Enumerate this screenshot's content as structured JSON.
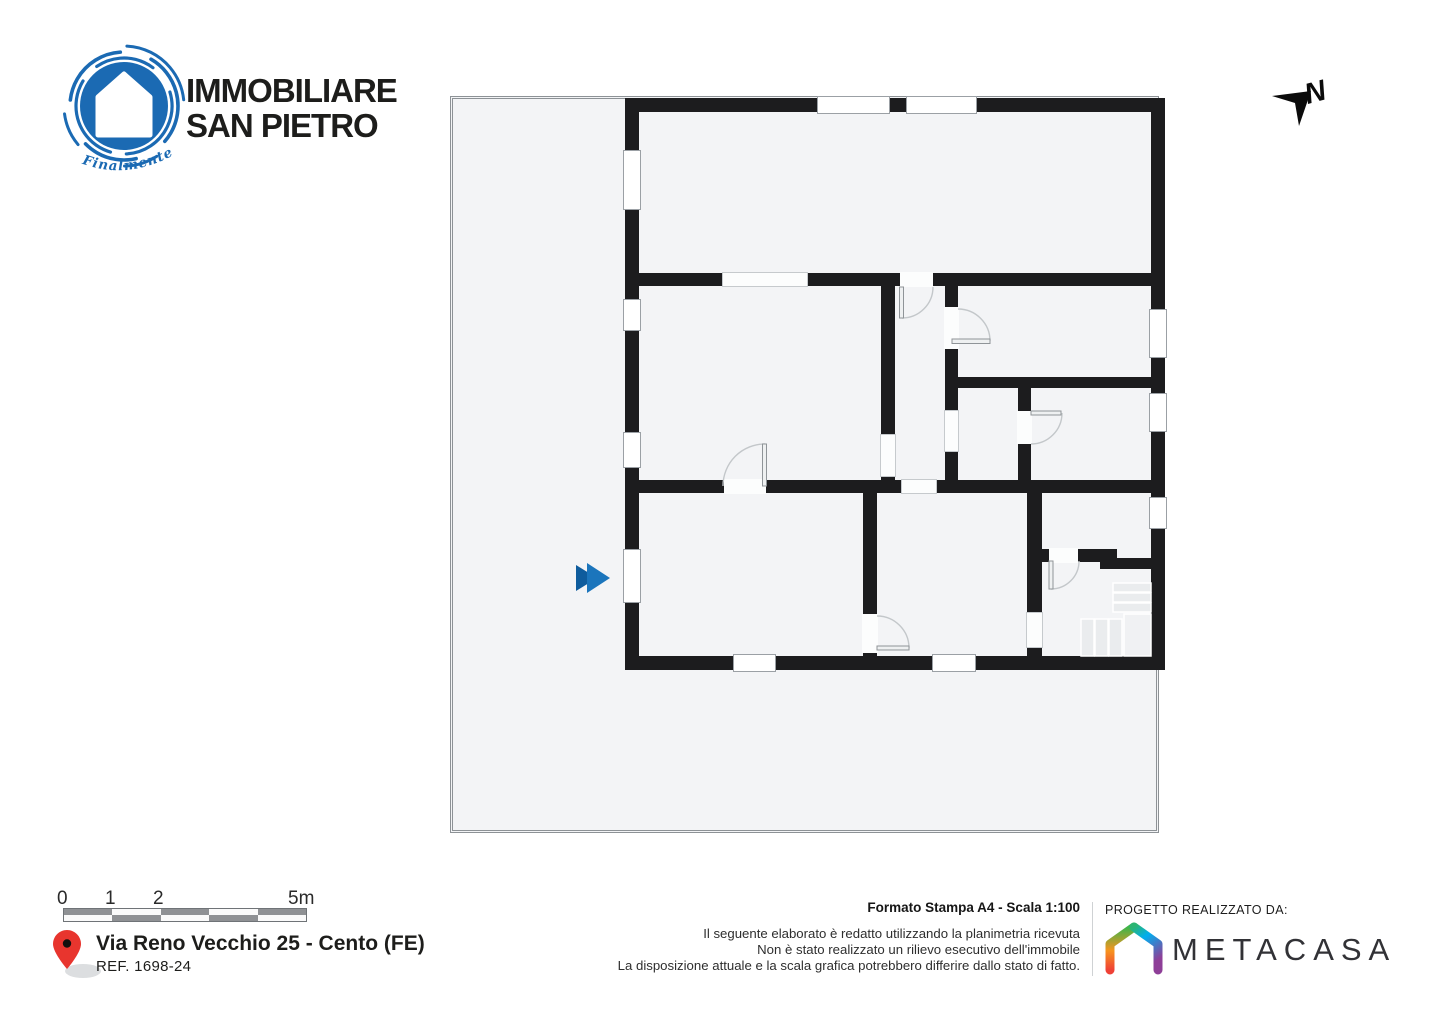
{
  "brand": {
    "name_line1": "IMMOBILIARE",
    "name_line2": "SAN PIETRO",
    "tagline": "Finalmente a Casa",
    "accent_color": "#1b6ab3"
  },
  "compass": {
    "label": "N"
  },
  "floorplan": {
    "wall_color": "#1c1c1e",
    "floor_color": "#f3f4f6",
    "entrance_marker_color": "#1b75bc",
    "entrance_marker_shadow_color": "#0e5c9d"
  },
  "scale_bar": {
    "labels": [
      "0",
      "1",
      "2",
      "5m"
    ]
  },
  "address": {
    "street": "Via Reno Vecchio 25 - Cento (FE)",
    "reference": "REF. 1698-24",
    "pin_color": "#e8352e"
  },
  "print_info": {
    "format_scale": "Formato Stampa A4 - Scala 1:100",
    "disclaimer_line1": "Il seguente elaborato è redatto utilizzando la planimetria ricevuta",
    "disclaimer_line2": "Non è stato realizzato un rilievo esecutivo dell'immobile",
    "disclaimer_line3": "La disposizione attuale e la scala grafica potrebbero differire dallo stato di fatto."
  },
  "credits": {
    "heading": "PROGETTO REALIZZATO DA:",
    "brand_name": "METACASA"
  }
}
